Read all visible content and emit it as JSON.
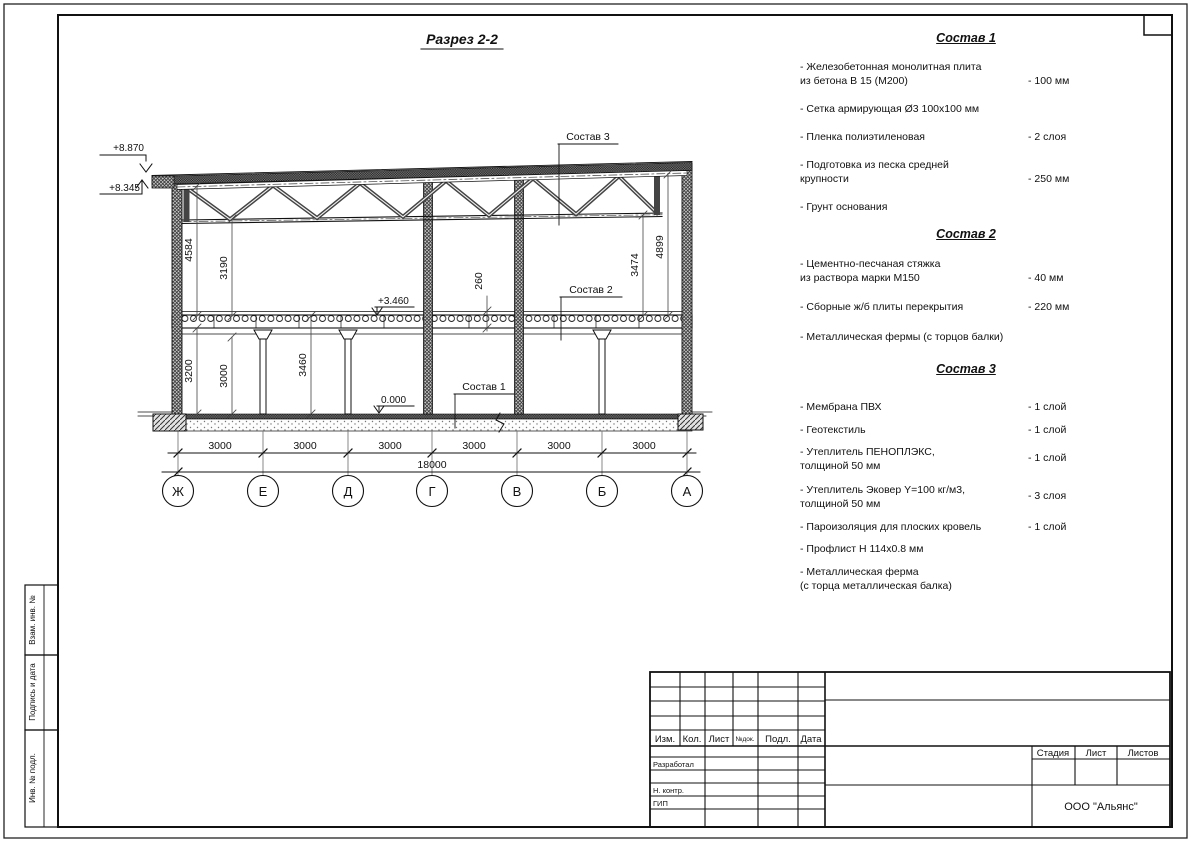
{
  "drawing": {
    "title": "Разрез 2-2",
    "elevations": {
      "roof_high": "+8.870",
      "roof_eave": "+8.345",
      "floor2": "+3.460",
      "ground": "0.000"
    },
    "dims": {
      "d4584": "4584",
      "d3190": "3190",
      "d3200": "3200",
      "d3000v": "3000",
      "d3460": "3460",
      "d260": "260",
      "d3474": "3474",
      "d4899": "4899",
      "total": "18000"
    },
    "bottom_dims": [
      "3000",
      "3000",
      "3000",
      "3000",
      "3000",
      "3000"
    ],
    "axes": [
      "Ж",
      "Е",
      "Д",
      "Г",
      "В",
      "Б",
      "А"
    ],
    "callouts": {
      "c1": "Состав 1",
      "c2": "Состав 2",
      "c3": "Состав 3"
    }
  },
  "specs": [
    {
      "heading": "Состав 1",
      "items": [
        {
          "text": "- Железобетонная  монолитная плита\nиз бетона В 15 (М200)",
          "value": "- 100 мм"
        },
        {
          "text": "- Сетка армирующая Ø3 100х100 мм",
          "value": ""
        },
        {
          "text": "- Пленка полиэтиленовая",
          "value": "- 2 слоя"
        },
        {
          "text": "- Подготовка из песка средней\nкрупности",
          "value": "- 250 мм"
        },
        {
          "text": "- Грунт основания",
          "value": ""
        }
      ]
    },
    {
      "heading": "Состав 2",
      "items": [
        {
          "text": "- Цементно-песчаная стяжка\nиз раствора марки М150",
          "value": "- 40 мм"
        },
        {
          "text": "- Сборные ж/б плиты перекрытия",
          "value": "- 220 мм"
        },
        {
          "text": "- Металлическая фермы (с торцов балки)",
          "value": ""
        }
      ]
    },
    {
      "heading": "Состав 3",
      "items": [
        {
          "text": "- Мембрана ПВХ",
          "value": "- 1 слой"
        },
        {
          "text": "- Геотекстиль",
          "value": "- 1 слой"
        },
        {
          "text": "- Утеплитель ПЕНОПЛЭКС,\nтолщиной 50 мм",
          "value": "- 1 слой"
        },
        {
          "text": "- Утеплитель Эковер Y=100 кг/м3,\nтолщиной 50 мм",
          "value": "- 3 слоя"
        },
        {
          "text": "- Пароизоляция для плоских кровель",
          "value": "- 1 слой"
        },
        {
          "text": "- Профлист Н 114х0.8 мм",
          "value": ""
        },
        {
          "text": "- Металлическая ферма\n(с торца металлическая балка)",
          "value": ""
        }
      ]
    }
  ],
  "stamp": {
    "cols": [
      "Изм.",
      "Кол.",
      "Лист",
      "№док.",
      "Подл.",
      "Дата"
    ],
    "rows": [
      "Разработал",
      "Н. контр.",
      "ГИП"
    ],
    "stage_cols": [
      "Стадия",
      "Лист",
      "Листов"
    ],
    "company": "ООО \"Альянс\""
  },
  "side_strip": [
    "Взам. инв. №",
    "Подпись и дата",
    "Инв. № подл."
  ]
}
